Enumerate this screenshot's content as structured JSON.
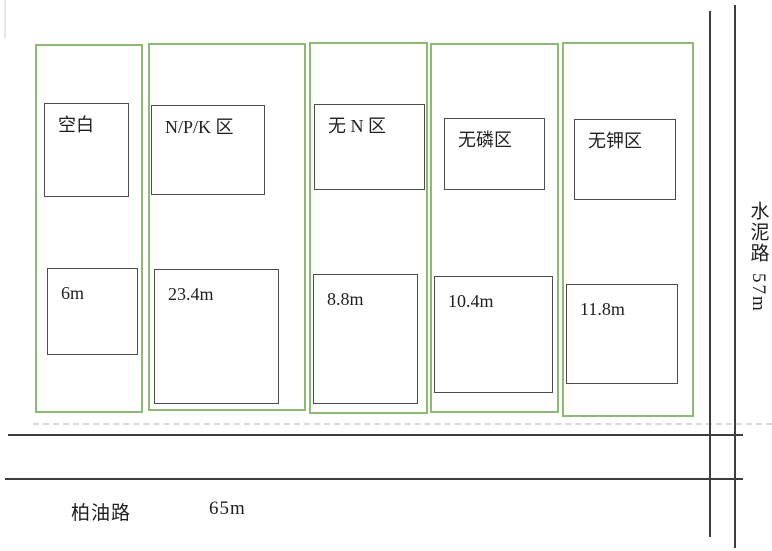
{
  "plots": [
    {
      "label": "空白",
      "size": "6m"
    },
    {
      "label": "N/P/K  区",
      "size": "23.4m"
    },
    {
      "label": "无 N 区",
      "size": "8.8m"
    },
    {
      "label": "无磷区",
      "size": "10.4m"
    },
    {
      "label": "无钾区",
      "size": "11.8m"
    }
  ],
  "roads": {
    "right": {
      "name": "水泥路",
      "length": "57m"
    },
    "bottom": {
      "name": "柏油路",
      "length": "65m"
    }
  },
  "colors": {
    "plot_border": "#8cb973",
    "box_border": "#4c4c4c",
    "road_line": "#3d3d3d",
    "text": "#1e1e1e"
  }
}
